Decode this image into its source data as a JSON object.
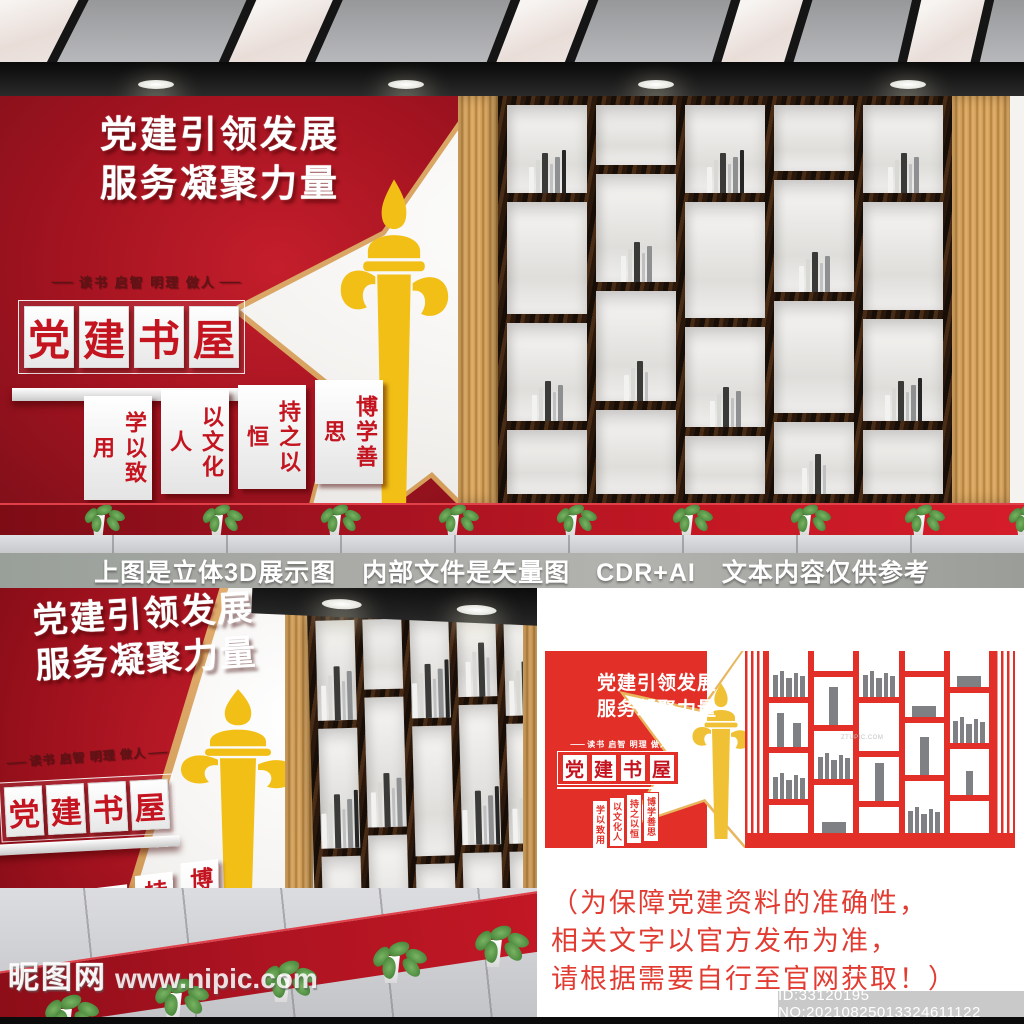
{
  "design": {
    "title_line1": "党建引领发展",
    "title_line2": "服务凝聚力量",
    "slogan": "读书 启智 明理 做人",
    "dash": "—",
    "sign_chars": [
      "党",
      "建",
      "书",
      "屋"
    ],
    "strips": [
      "学以致用",
      "以文化人",
      "持之以恒",
      "博学善思"
    ]
  },
  "divider": {
    "note": "上图是立体3D展示图　内部文件是矢量图　CDR+AI　文本内容仅供参考"
  },
  "disclaimer": {
    "line1": "（为保障党建资料的准确性，",
    "line2": "相关文字以官方发布为准，",
    "line3": "请根据需要自行至官网获取！）"
  },
  "watermarks": {
    "site_name": "昵图网",
    "site_url": "www.nipic.com",
    "vector_watermark": "ZTUPIC.COM",
    "id_text": "ID:33120195 NO:20210825013324611122"
  },
  "colors": {
    "red_3d": "#a31320",
    "red_flat": "#e23028",
    "gold": "#f2bf16",
    "wood": "#d8a45f",
    "shelf_dark": "#2b1a0e",
    "book_gray": "#7e8083"
  },
  "scene_top": {
    "skylights": [
      {
        "x": -30,
        "w": 95,
        "r": 27
      },
      {
        "x": 235,
        "w": 88,
        "r": 24
      },
      {
        "x": 500,
        "w": 82,
        "r": 21
      },
      {
        "x": 722,
        "w": 78,
        "r": 17
      },
      {
        "x": 905,
        "w": 80,
        "r": 13
      }
    ],
    "downlights": [
      138,
      388,
      638,
      890
    ],
    "shelf_columns": [
      [
        {
          "h": 88,
          "b": 6
        },
        {
          "h": 112,
          "b": 0
        },
        {
          "h": 98,
          "b": 5
        },
        {
          "h": 64,
          "b": 0
        }
      ],
      [
        {
          "h": 60,
          "b": 0
        },
        {
          "h": 108,
          "b": 5
        },
        {
          "h": 110,
          "b": 4
        },
        {
          "h": 84,
          "b": 0
        }
      ],
      [
        {
          "h": 88,
          "b": 6
        },
        {
          "h": 116,
          "b": 0
        },
        {
          "h": 100,
          "b": 5
        },
        {
          "h": 58,
          "b": 0
        }
      ],
      [
        {
          "h": 66,
          "b": 0
        },
        {
          "h": 112,
          "b": 5
        },
        {
          "h": 112,
          "b": 0
        },
        {
          "h": 72,
          "b": 4
        }
      ],
      [
        {
          "h": 88,
          "b": 5
        },
        {
          "h": 108,
          "b": 0
        },
        {
          "h": 102,
          "b": 6
        },
        {
          "h": 64,
          "b": 0
        }
      ]
    ],
    "plants_x": [
      80,
      198,
      316,
      434,
      552,
      668,
      786,
      900,
      1004
    ]
  },
  "scene_left": {
    "downlights": [
      70,
      205
    ],
    "shelf_columns": [
      [
        {
          "h": 100,
          "b": 5
        },
        {
          "h": 120,
          "b": 6
        },
        {
          "h": 118,
          "b": 5
        }
      ],
      [
        {
          "h": 70,
          "b": 0
        },
        {
          "h": 130,
          "b": 5
        },
        {
          "h": 138,
          "b": 6
        }
      ],
      [
        {
          "h": 100,
          "b": 6
        },
        {
          "h": 130,
          "b": 0
        },
        {
          "h": 108,
          "b": 5
        }
      ],
      [
        {
          "h": 80,
          "b": 4
        },
        {
          "h": 140,
          "b": 6
        },
        {
          "h": 118,
          "b": 0
        }
      ],
      [
        {
          "h": 100,
          "b": 5
        },
        {
          "h": 120,
          "b": 5
        },
        {
          "h": 118,
          "b": 6
        }
      ]
    ],
    "plants": [
      [
        38,
        404
      ],
      [
        148,
        388
      ],
      [
        256,
        370
      ],
      [
        366,
        351
      ],
      [
        468,
        335
      ]
    ]
  },
  "vector_shelf": {
    "columns": [
      [
        {
          "h": 46,
          "b": "g"
        },
        {
          "h": 44,
          "b": "2"
        },
        {
          "h": 46,
          "b": "g"
        },
        {
          "h": 28,
          "b": ""
        }
      ],
      [
        {
          "h": 20,
          "b": ""
        },
        {
          "h": 48,
          "b": "1t"
        },
        {
          "h": 48,
          "b": "g"
        },
        {
          "h": 48,
          "b": "w"
        }
      ],
      [
        {
          "h": 46,
          "b": "g"
        },
        {
          "h": 48,
          "b": ""
        },
        {
          "h": 44,
          "b": "1t"
        },
        {
          "h": 26,
          "b": ""
        }
      ],
      [
        {
          "h": 20,
          "b": ""
        },
        {
          "h": 40,
          "b": "w"
        },
        {
          "h": 52,
          "b": "1t"
        },
        {
          "h": 52,
          "b": "g"
        }
      ],
      [
        {
          "h": 36,
          "b": "w"
        },
        {
          "h": 50,
          "b": "g"
        },
        {
          "h": 46,
          "b": "1"
        },
        {
          "h": 32,
          "b": ""
        }
      ]
    ]
  }
}
